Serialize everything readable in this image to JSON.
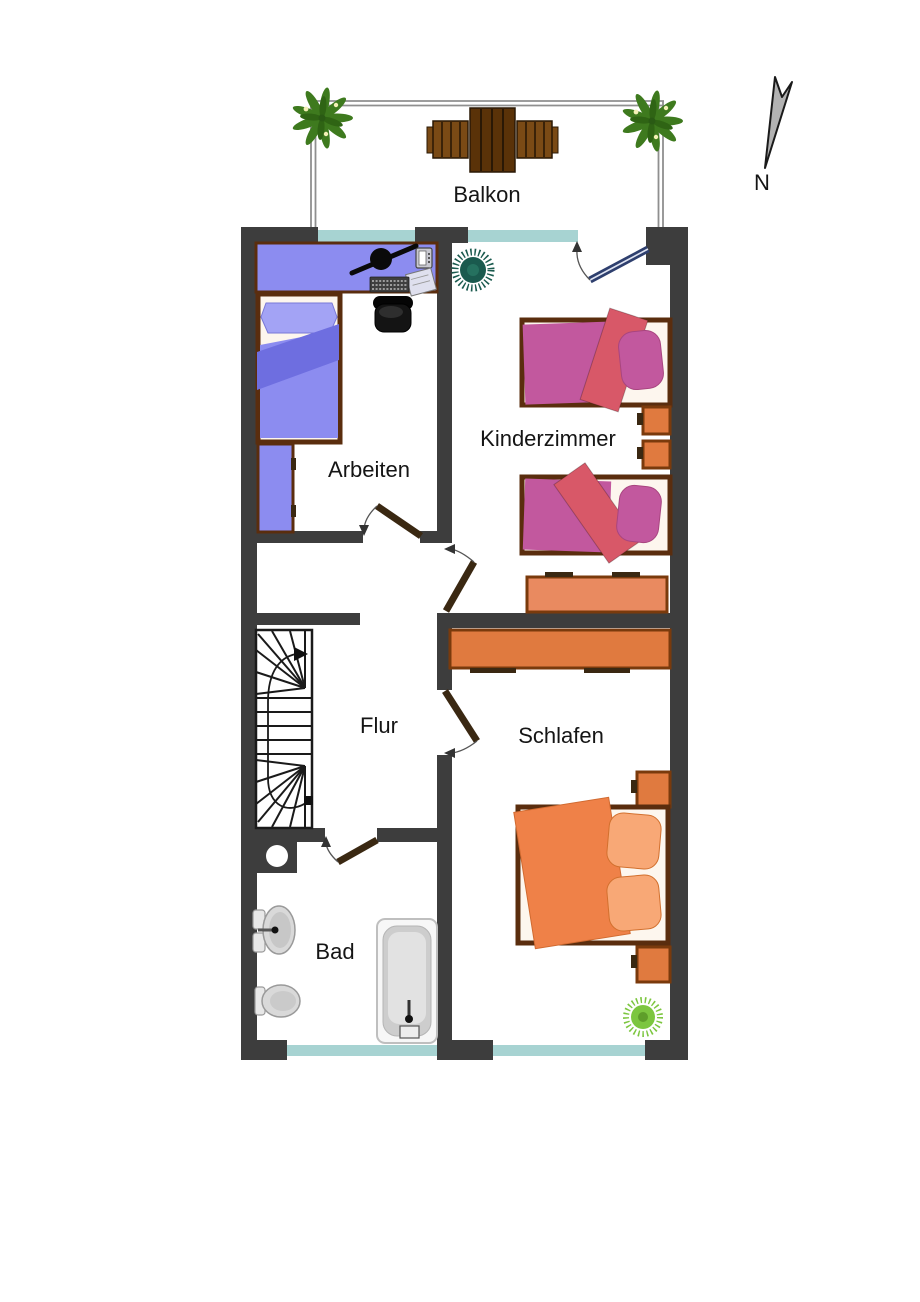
{
  "plan": {
    "rooms": {
      "balcony": {
        "label": "Balkon"
      },
      "office": {
        "label": "Arbeiten"
      },
      "kids_room": {
        "label": "Kinderzimmer"
      },
      "hallway": {
        "label": "Flur"
      },
      "bedroom": {
        "label": "Schlafen"
      },
      "bathroom": {
        "label": "Bad"
      }
    },
    "compass": {
      "label": "N"
    }
  },
  "colors": {
    "wall": "#3d3d3d",
    "window": "#a7d3d2",
    "door": "#3a2812",
    "balcony_door": "#2e3f6e",
    "frame": "#5a2d0e",
    "mattress": "#fdf6ee",
    "purple": "#8c8cf0",
    "purple_light": "#a3a3f5",
    "purple_dark": "#6e6ee0",
    "magenta": "#c2589e",
    "salmon": "#d85868",
    "orange": "#e07a3f",
    "orange_light": "#e98a60",
    "orange_border": "#7a3a0c",
    "bed_orange": "#ef8148",
    "pillow_orange": "#f8a876",
    "table_wood": "#5a3208",
    "chair_wood": "#7a4a15",
    "fern": "#3e7a1e",
    "plant_dark": "#1a5a4e",
    "plant_light": "#7cc63f",
    "rail": "#8f8f8f",
    "compass_fill": "#b2b2b2"
  }
}
